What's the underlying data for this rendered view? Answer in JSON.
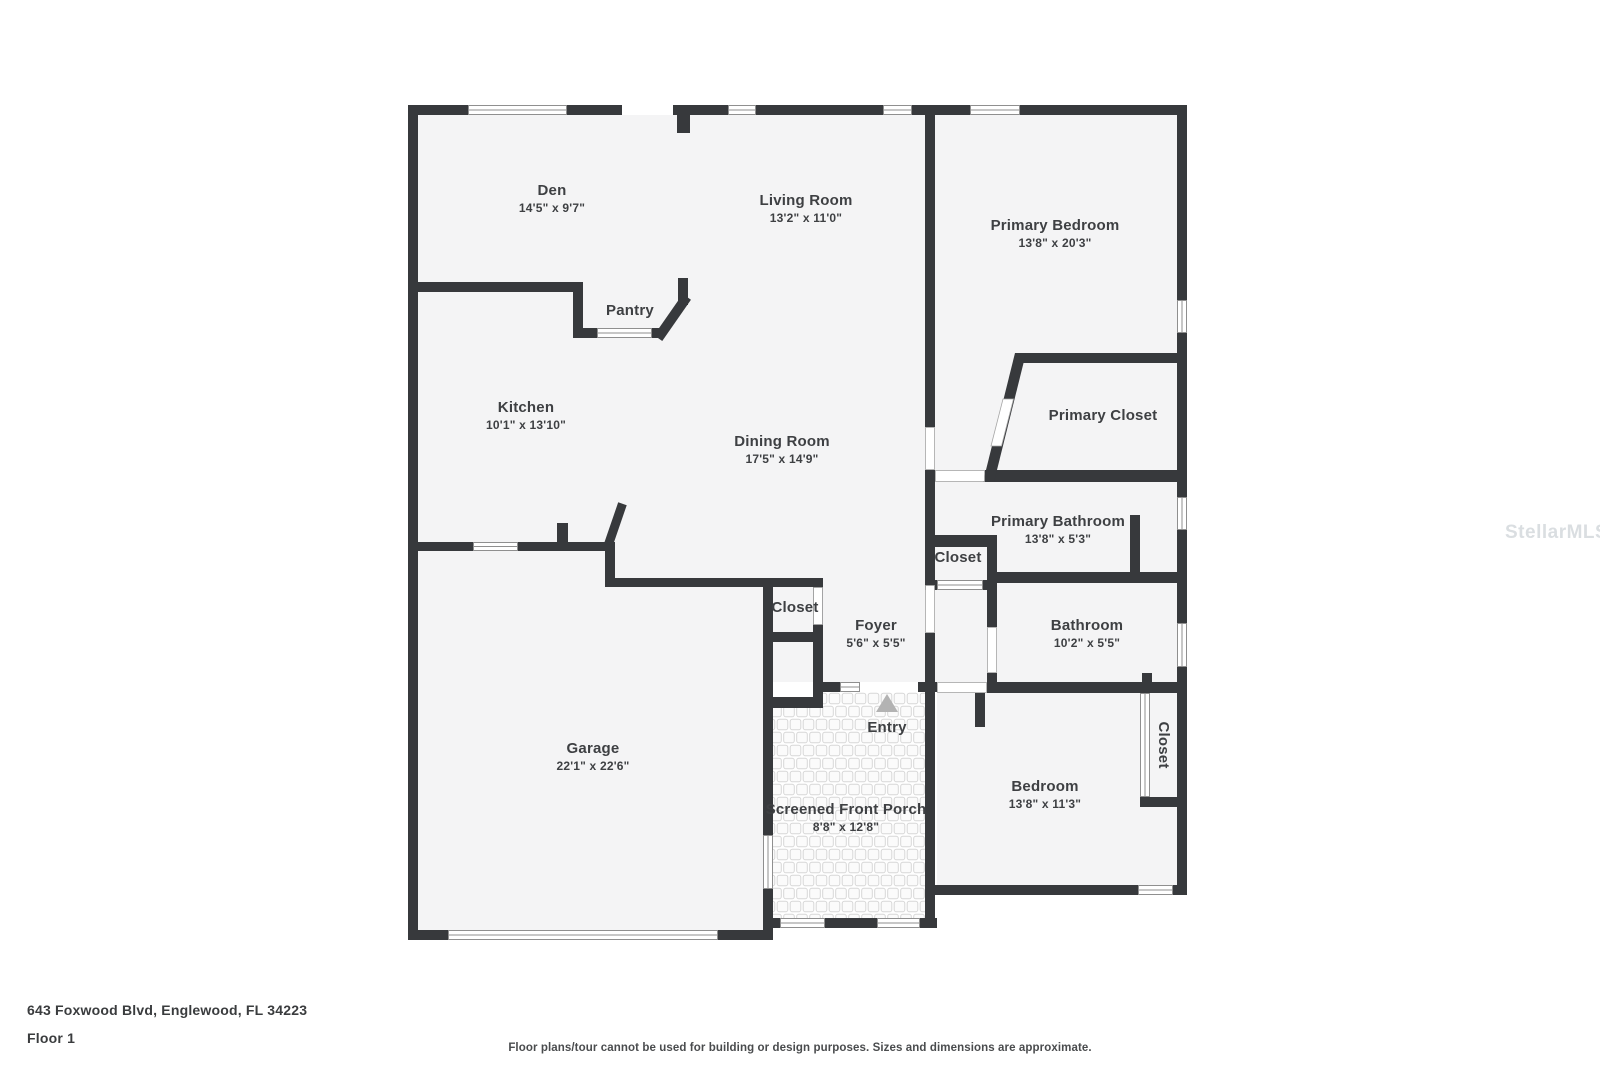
{
  "colors": {
    "wall": "#37393c",
    "floor": "#f4f4f5",
    "label_text": "#3e4043",
    "entry_triangle": "#b3b3b3",
    "tile_grout": "#d7d7d7",
    "watermark_gray": "#bbc3c9"
  },
  "rooms": {
    "den": {
      "label": "Den",
      "dims": "14'5\" x 9'7\""
    },
    "living_room": {
      "label": "Living Room",
      "dims": "13'2\" x 11'0\""
    },
    "primary_bedroom": {
      "label": "Primary Bedroom",
      "dims": "13'8\" x 20'3\""
    },
    "pantry": {
      "label": "Pantry"
    },
    "kitchen": {
      "label": "Kitchen",
      "dims": "10'1\" x 13'10\""
    },
    "dining_room": {
      "label": "Dining Room",
      "dims": "17'5\" x 14'9\""
    },
    "primary_closet": {
      "label": "Primary Closet"
    },
    "primary_bathroom": {
      "label": "Primary Bathroom",
      "dims": "13'8\" x 5'3\""
    },
    "hall_closet": {
      "label": "Closet"
    },
    "garage_closet": {
      "label": "Closet"
    },
    "foyer": {
      "label": "Foyer",
      "dims": "5'6\" x 5'5\""
    },
    "bathroom": {
      "label": "Bathroom",
      "dims": "10'2\" x 5'5\""
    },
    "entry": {
      "label": "Entry"
    },
    "garage": {
      "label": "Garage",
      "dims": "22'1\" x 22'6\""
    },
    "screened_front_porch": {
      "label": "Screened Front Porch",
      "dims": "8'8\" x 12'8\""
    },
    "bedroom": {
      "label": "Bedroom",
      "dims": "13'8\" x 11'3\""
    },
    "bedroom_closet": {
      "label": "Closet"
    }
  },
  "footer": {
    "address": "643 Foxwood Blvd, Englewood, FL 34223",
    "floor": "Floor 1",
    "disclaimer": "Floor plans/tour cannot be used for building or design purposes. Sizes and dimensions are approximate."
  },
  "watermark": {
    "text": "StellarMLS"
  }
}
